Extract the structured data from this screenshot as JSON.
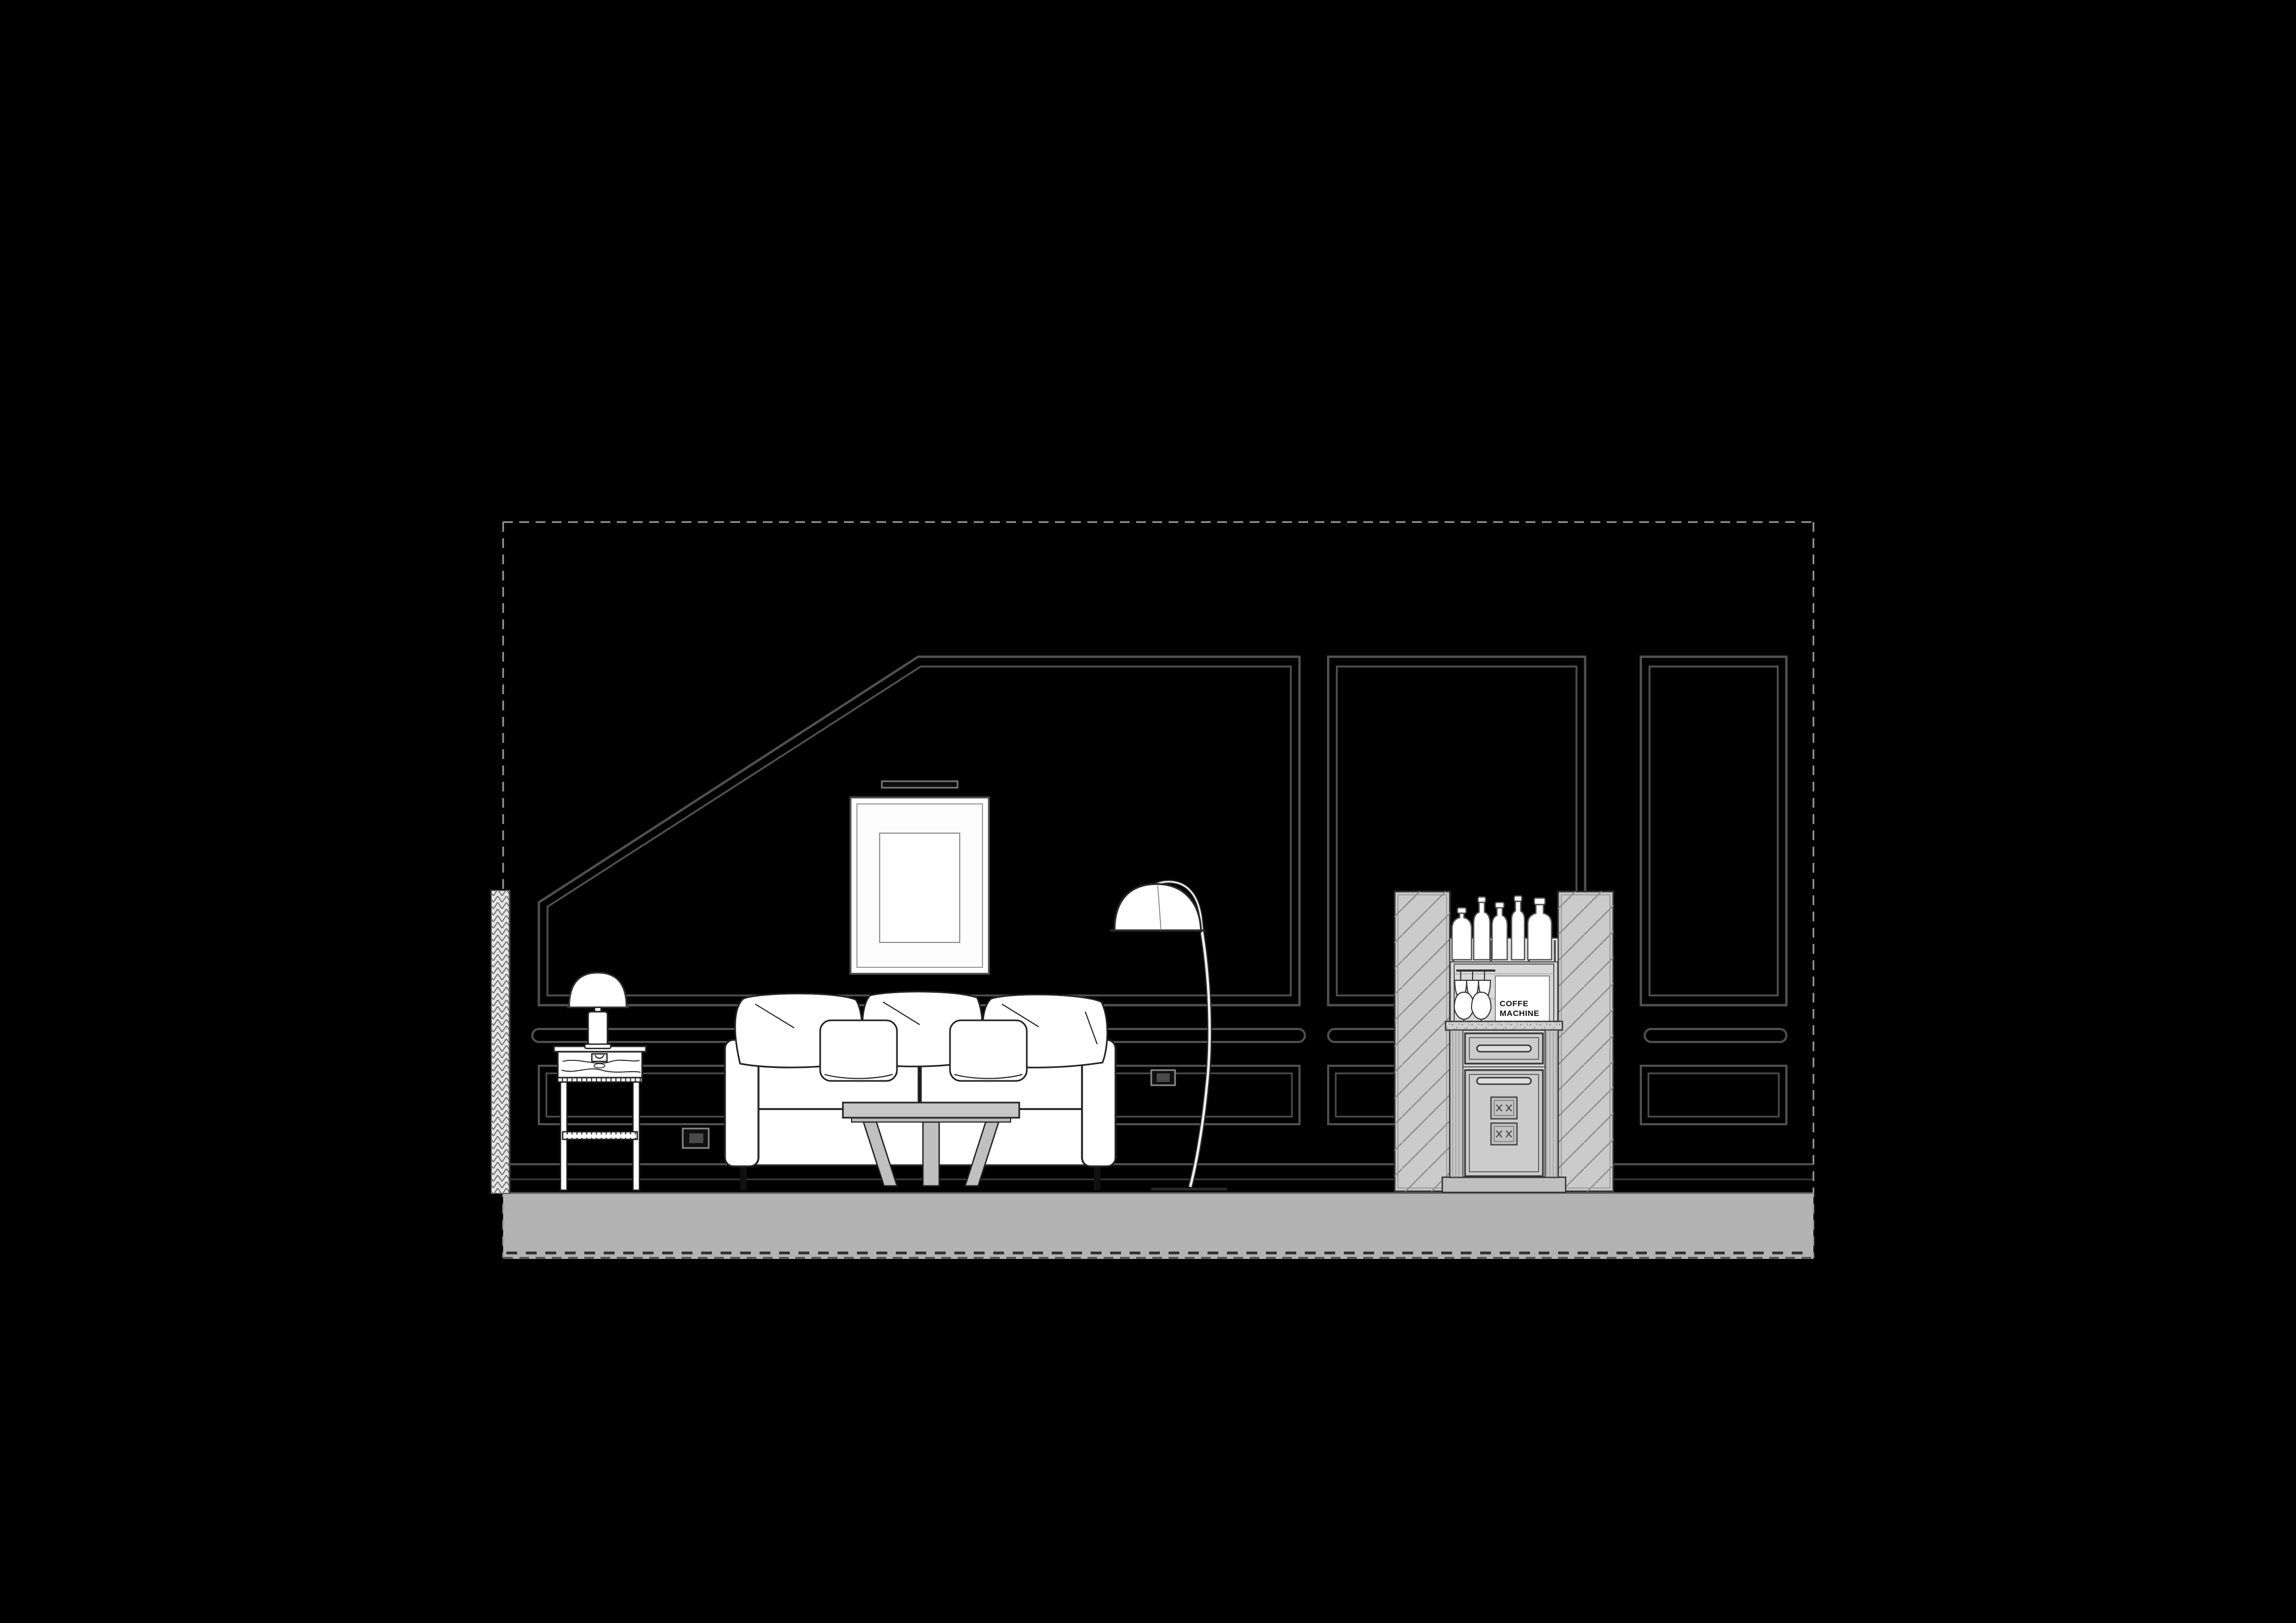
{
  "drawing": {
    "kind": "interior-elevation",
    "labels": {
      "coffee_machine_line1": "COFFE",
      "coffee_machine_line2": "MACHINE"
    },
    "objects": [
      "dashed-drawing-border",
      "section-cut-hatch",
      "sloped-wall-panel",
      "center-wall-panel",
      "right-wall-panel",
      "chair-rail",
      "lower-wainscot-panel",
      "baseboard",
      "floor-slab",
      "picture-light",
      "picture-frame",
      "table-lamp",
      "side-table",
      "power-outlet",
      "sofa",
      "back-pillows",
      "accent-pillows",
      "coffee-table",
      "arc-floor-lamp",
      "minibar-cabinet",
      "mirror-side-panels",
      "liquor-bottles",
      "hanging-stemware",
      "brandy-glasses",
      "coffee-machine-box",
      "drawer",
      "cabinet-door",
      "vent-grilles",
      "plinth"
    ]
  },
  "palette": {
    "background": "#000000",
    "molding_gray": "#4f4f4f",
    "dashed_border": "#9a9a9a",
    "floor_gray": "#b3b3b3",
    "furniture_fill": "#ffffff",
    "furniture_outline": "#222222",
    "cabinet_fill": "#cccccc",
    "hatch_line": "#8f8f8f",
    "label_color": "#111111"
  }
}
